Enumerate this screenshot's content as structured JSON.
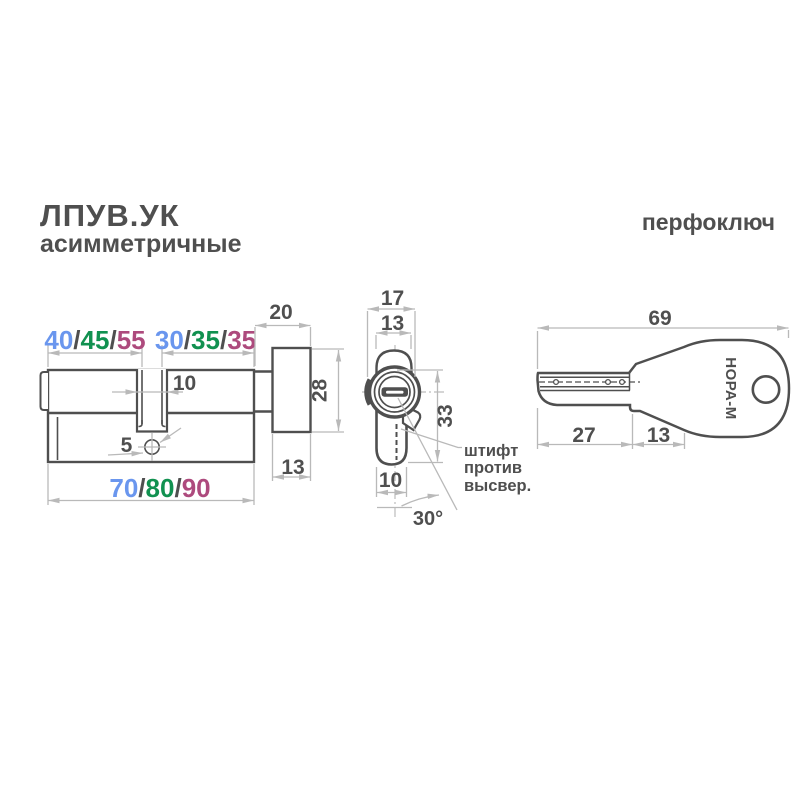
{
  "header": {
    "title_line1": "ЛПУВ.УК",
    "title_line2": "асимметричные",
    "right_label": "перфоключ"
  },
  "colors": {
    "outline": "#4f4f4f",
    "dimension_lines": "#b9b9b9",
    "size_blue": "#6a96ee",
    "size_green": "#119150",
    "size_magenta": "#ad4a7d"
  },
  "side_view": {
    "slash": "/",
    "seg_a": [
      "40",
      "45",
      "55"
    ],
    "seg_b": [
      "30",
      "35",
      "35"
    ],
    "seg_total": [
      "70",
      "80",
      "90"
    ],
    "cam_width": "10",
    "screw_hole": "5",
    "knob_depth": "20",
    "knob_height": "28",
    "knob_width": "13"
  },
  "front_view": {
    "overall_width": "17",
    "plug_width": "13",
    "height": "33",
    "body_width": "10",
    "cam_angle": "30°",
    "note_line1": "штифт",
    "note_line2": "против",
    "note_line3": "высвер."
  },
  "key_view": {
    "total_length": "69",
    "blade_length": "27",
    "neck_length": "13",
    "brand": "НОРА-М"
  }
}
